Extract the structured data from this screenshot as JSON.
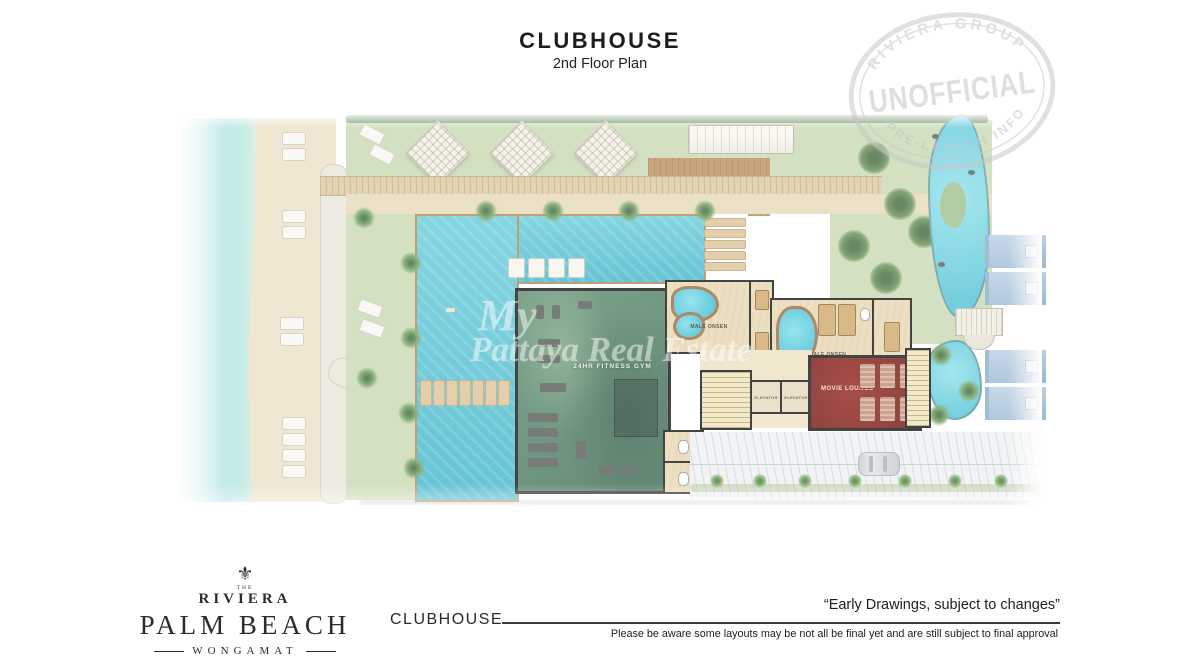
{
  "header": {
    "title": "CLUBHOUSE",
    "subtitle": "2nd Floor Plan"
  },
  "stamp": {
    "arc_top": "RIVIERA GROUP",
    "main": "UNOFFICIAL",
    "arc_bottom": "PRE-LAUNCH INFO"
  },
  "watermark": {
    "line1": "My",
    "line2": "Pattaya Real Estate"
  },
  "plan": {
    "labels": {
      "gym": "24HR FITNESS GYM",
      "male_onsen": "MALE ONSEN",
      "female_onsen": "FEMALE ONSEN",
      "movie_lounge": "MOVIE LOUNGE",
      "elevator": "ELEVATOR"
    },
    "colors": {
      "pool": "#4fbfd2",
      "sea": "#8fd8d6",
      "lawn": "#c9dab3",
      "sand": "#ece1c6",
      "gym_floor": "#4d7c63",
      "movie_red": "#7c1a13",
      "roof_blue": "#aec7dd"
    }
  },
  "footer": {
    "logo": {
      "the": "THE",
      "brand": "RIVIERA",
      "name": "PALM BEACH",
      "location": "WONGAMAT",
      "ornament": "⚜"
    },
    "plan_label": "CLUBHOUSE",
    "quote": "“Early Drawings, subject to changes”",
    "disclaimer": "Please be aware some layouts may be not all be final yet and are still subject to final approval"
  }
}
